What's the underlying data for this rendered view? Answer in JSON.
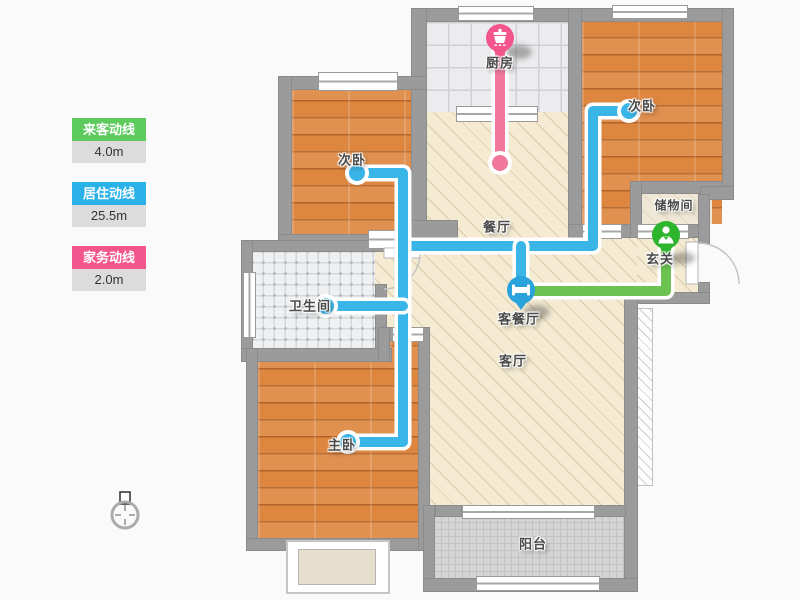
{
  "legend": [
    {
      "label": "来客动线",
      "value": "4.0m",
      "color": "#5dca5d"
    },
    {
      "label": "居住动线",
      "value": "25.5m",
      "color": "#2ab2e8"
    },
    {
      "label": "家务动线",
      "value": "2.0m",
      "color": "#f2568c"
    }
  ],
  "rooms": {
    "kitchen": {
      "label": "厨房"
    },
    "bedroom_right": {
      "label": "次卧"
    },
    "bedroom_left": {
      "label": "次卧"
    },
    "dining": {
      "label": "餐厅"
    },
    "storage": {
      "label": "储物间"
    },
    "entry": {
      "label": "玄关"
    },
    "bathroom": {
      "label": "卫生间"
    },
    "living_dining": {
      "label": "客餐厅"
    },
    "living": {
      "label": "客厅"
    },
    "master": {
      "label": "主卧"
    },
    "balcony": {
      "label": "阳台"
    }
  },
  "pins": {
    "kitchen": {
      "icon": "pot-icon",
      "color": "#f2558c"
    },
    "entry": {
      "icon": "person-icon",
      "color": "#2db52d"
    },
    "living_dining": {
      "icon": "bed-icon",
      "color": "#2aa2dc"
    }
  },
  "lines": {
    "guest": {
      "color": "#6cc351"
    },
    "living": {
      "color": "#3ab5e8"
    },
    "housework": {
      "color": "#f1789c"
    }
  }
}
